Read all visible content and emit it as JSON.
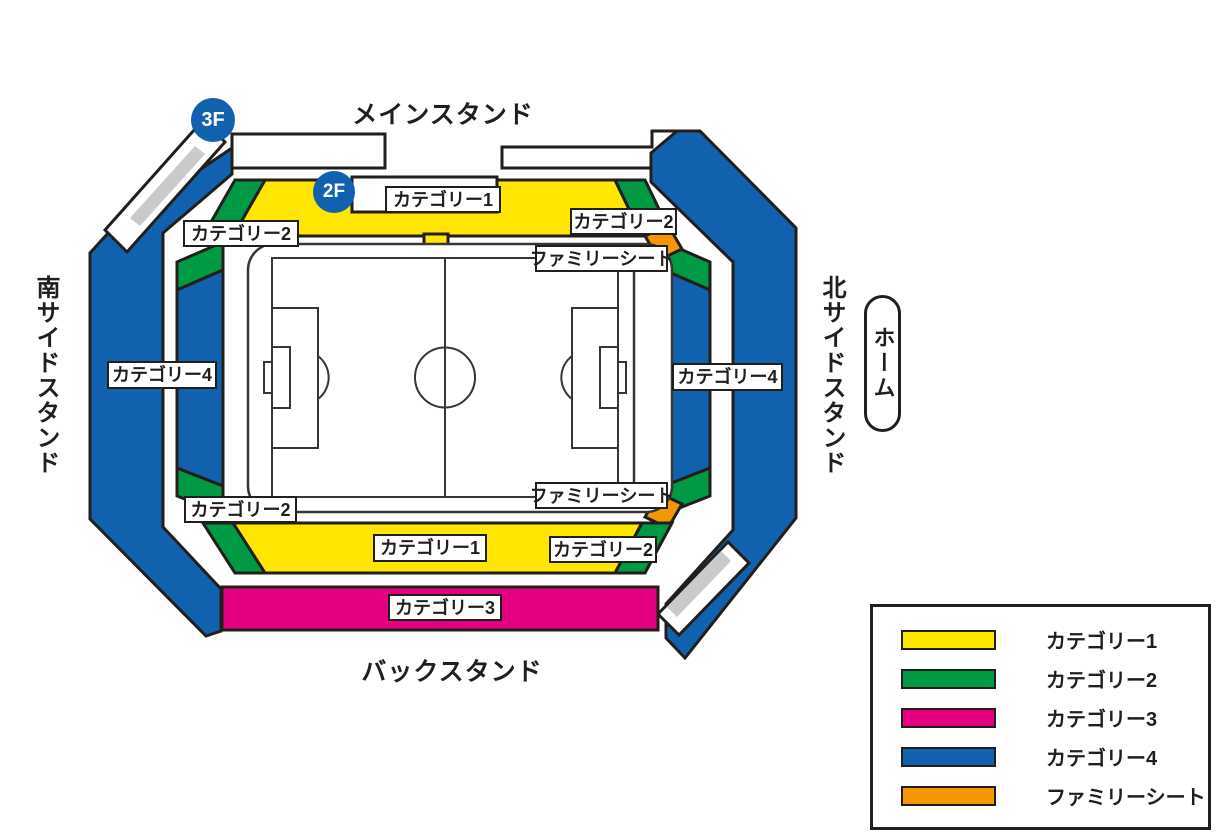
{
  "stadium": {
    "stands": {
      "main": "メインスタンド",
      "back": "バックスタンド",
      "south": "南サイドスタンド",
      "north": "北サイドスタンド"
    },
    "home_badge": "ホーム",
    "floors": {
      "third": "3F",
      "second": "2F"
    },
    "sections": {
      "category1": "カテゴリー1",
      "category2": "カテゴリー2",
      "category3": "カテゴリー3",
      "category4": "カテゴリー4",
      "family_seat": "ファミリーシート"
    }
  },
  "legend": {
    "items": [
      {
        "label": "カテゴリー1",
        "color_key": "category1"
      },
      {
        "label": "カテゴリー2",
        "color_key": "category2"
      },
      {
        "label": "カテゴリー3",
        "color_key": "category3"
      },
      {
        "label": "カテゴリー4",
        "color_key": "category4"
      },
      {
        "label": "ファミリーシート",
        "color_key": "family_seat"
      }
    ]
  },
  "colors": {
    "category1": "#FFE600",
    "category2": "#009944",
    "category3": "#E4007F",
    "category4": "#1261AE",
    "family_seat": "#F39800",
    "outline": "#221E1B",
    "ramp_gray": "#C9CACA",
    "pitch_line": "#3A3432"
  }
}
